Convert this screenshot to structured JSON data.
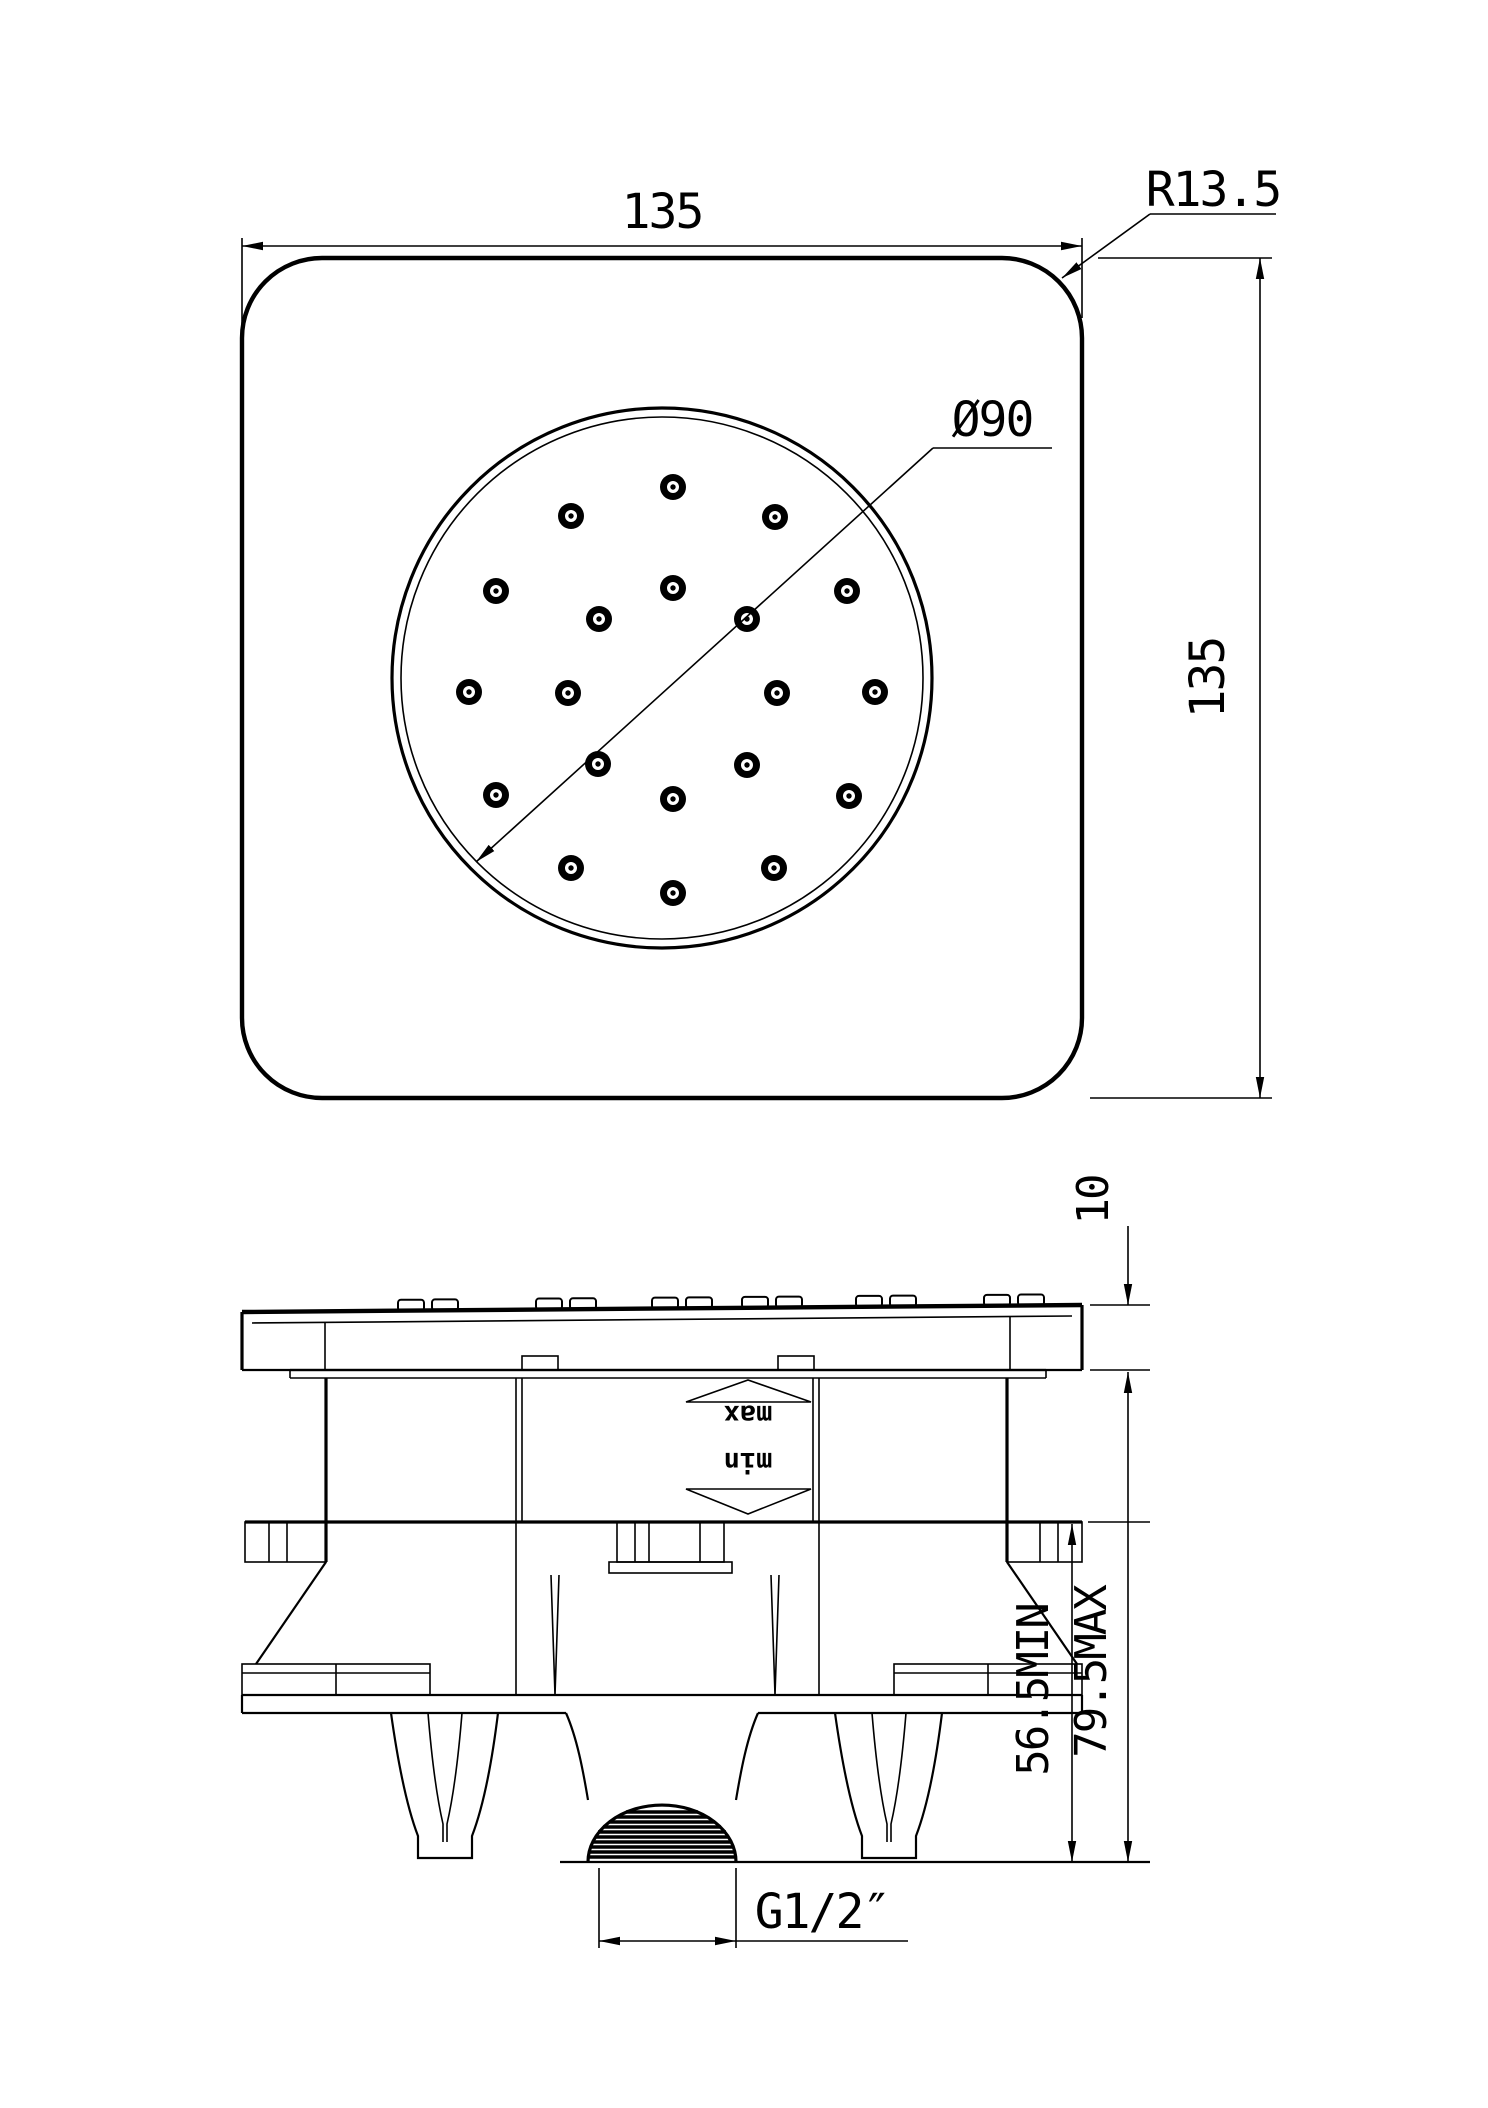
{
  "page": {
    "background": "#ffffff",
    "ink": "#000000"
  },
  "dimensions": {
    "top_width": "135",
    "side_height": "135",
    "corner_radius": "R13.5",
    "spray_diameter": "Ø90",
    "plate_thickness": "10",
    "install_depth_min": "56.5MIN",
    "install_depth_max": "79.5MAX",
    "thread_size": "G1/2″"
  },
  "adjustment_markers": {
    "max_label": "max",
    "min_label": "min"
  },
  "spray_face": {
    "circle": {
      "cx": 662,
      "cy": 678,
      "outer_r": 270,
      "inner_r": 261
    },
    "nozzle_outer_r": 13,
    "nozzle_ring_r": 6,
    "nozzle_dot_r": 2.7,
    "nozzle_offsets": [
      [
        11,
        -191
      ],
      [
        -91,
        -162
      ],
      [
        113,
        -161
      ],
      [
        -166,
        -87
      ],
      [
        11,
        -90
      ],
      [
        185,
        -87
      ],
      [
        -63,
        -59
      ],
      [
        85,
        -59
      ],
      [
        -193,
        14
      ],
      [
        -94,
        15
      ],
      [
        115,
        15
      ],
      [
        213,
        14
      ],
      [
        -64,
        86
      ],
      [
        85,
        87
      ],
      [
        -166,
        117
      ],
      [
        11,
        121
      ],
      [
        187,
        118
      ],
      [
        -91,
        190
      ],
      [
        112,
        190
      ],
      [
        11,
        215
      ]
    ]
  },
  "plate_bumps": {
    "xs": [
      398,
      432,
      536,
      570,
      652,
      686,
      742,
      776,
      856,
      890,
      984,
      1018
    ],
    "width": 26,
    "height": 11
  }
}
